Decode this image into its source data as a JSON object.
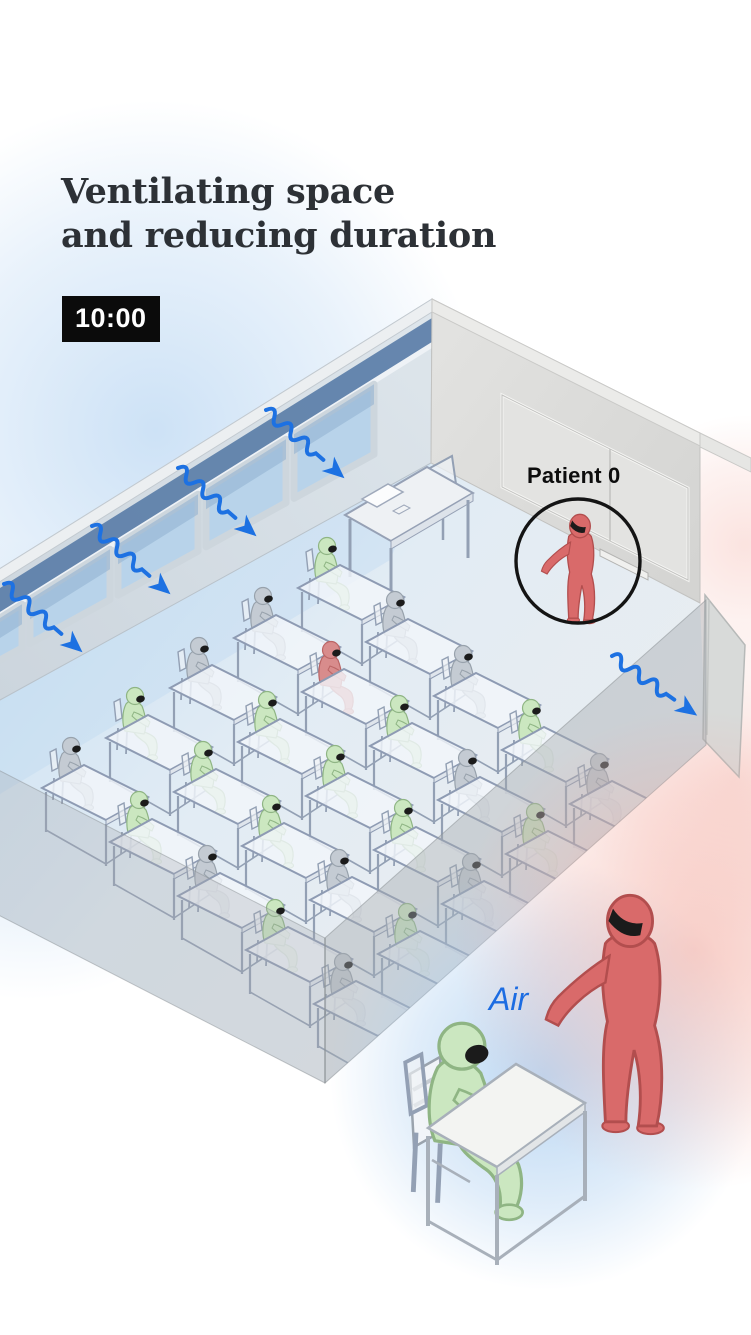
{
  "title": {
    "line1": "Ventilating space",
    "line2": "and reducing duration"
  },
  "time_badge": "10:00",
  "labels": {
    "patient_zero": "Patient 0",
    "air": "Air"
  },
  "palette": {
    "accent_blue": "#1d71e2",
    "infected_red": "#d96a6a",
    "infected_red_stroke": "#b24e4e",
    "healthy_green": "#cbe7c0",
    "healthy_green_stroke": "#8fb584",
    "neutral_gray": "#c4cbd3",
    "neutral_gray_stroke": "#98a2ac",
    "mask_black": "#1b1b1b",
    "desk_line": "#93a0b4",
    "desk_top": "rgba(241,245,250,0.82)",
    "wall_left": "#d7dfe6",
    "wall_right": "#dededc",
    "wall_top_band": "#eceff1",
    "window_transom_dark": "#5b7ea8",
    "window_glass": "#b8d3ea",
    "floor_near_windows": "#cde2f3",
    "floor_far": "#e9edf0",
    "front_wall_translucent": "rgba(164,170,174,0.42)",
    "whiteboard": "#e3e3e1",
    "circle_stroke": "#141414"
  },
  "scene": {
    "windows_x": [
      294,
      206,
      118,
      30,
      -58
    ],
    "arrows_in": [
      [
        266,
        410
      ],
      [
        178,
        468
      ],
      [
        92,
        526
      ],
      [
        4,
        584
      ],
      [
        -80,
        642
      ]
    ],
    "arrow_out": [
      [
        612,
        656
      ]
    ],
    "seating": {
      "origin": [
        330,
        580
      ],
      "col_step": [
        -64,
        50
      ],
      "row_step": [
        68,
        54
      ],
      "rows": [
        [
          "green",
          "gray",
          "gray",
          "green",
          "gray"
        ],
        [
          "gray",
          "infected",
          "green",
          "green",
          "green"
        ],
        [
          "gray",
          "green",
          "green",
          "green",
          "gray"
        ],
        [
          "green",
          "gray",
          "green",
          "gray",
          "green"
        ],
        [
          "gray",
          "green",
          "gray",
          "green",
          "gray"
        ]
      ]
    }
  }
}
